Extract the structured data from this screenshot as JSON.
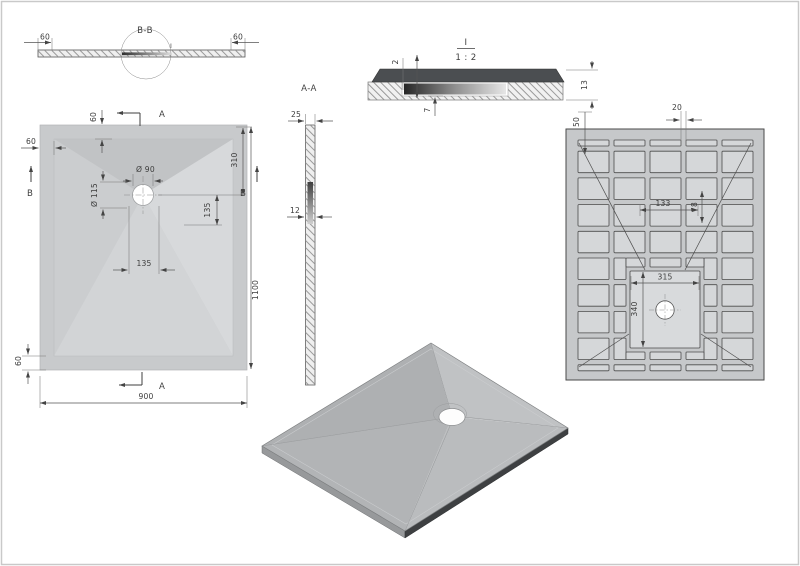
{
  "views": {
    "section_bb": {
      "title": "B-B",
      "dim_left": "60",
      "dim_right": "60",
      "detail_mark": "I"
    },
    "plan": {
      "dim_rim_top": "60",
      "dim_rim_left": "60",
      "dim_rim_bottom": "60",
      "dim_drain_dia": "Ø 90",
      "dim_recess_dia": "Ø 115",
      "dim_drain_offset": "310",
      "dim_recess_right": "135",
      "dim_recess_bottom": "135",
      "dim_width": "900",
      "dim_length": "1100",
      "cut_a": "A",
      "cut_b": "B"
    },
    "section_aa": {
      "title": "A-A",
      "dim_edge_width": "25",
      "dim_mid_width": "12"
    },
    "detail_i": {
      "title": "I",
      "scale": "1 : 2",
      "dim_top_layer": "2",
      "dim_recess_depth": "7",
      "dim_total_thickness": "13"
    },
    "bottom": {
      "dim_edge_margin": "50",
      "dim_rib_width": "20",
      "dim_cell_pitch": "133",
      "dim_cell_height": "78",
      "dim_center_width": "315",
      "dim_center_height": "340"
    }
  },
  "colors": {
    "tray_rim": "#c8cacc",
    "tray_slope_dark": "#c1c3c5",
    "tray_slope_light": "#d7d9db",
    "bottom_base": "#c6c8ca",
    "bottom_pocket": "#d5d7d9",
    "detail_top_layer": "#4b4e51",
    "iso_top": "#b5b7b9",
    "iso_side_dark": "#3e4042",
    "line": "#555555",
    "frame": "#c9c9c9"
  }
}
